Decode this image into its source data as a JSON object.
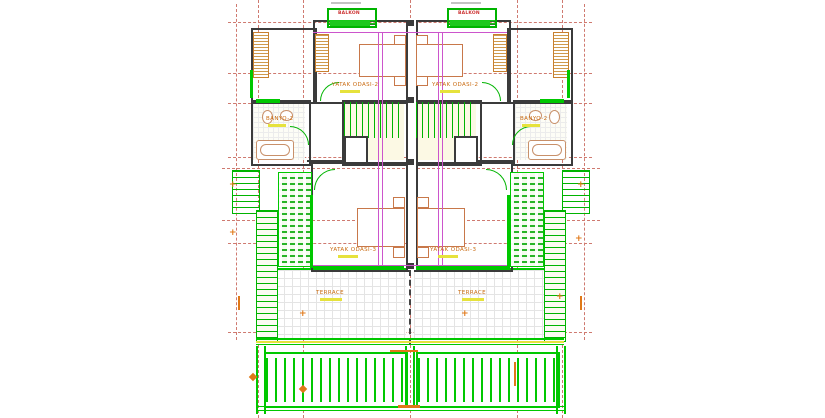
{
  "plan": {
    "type": "architectural-floor-plan",
    "labels": {
      "bedroom2": "YATAK ODASI-2",
      "bedroom3": "YATAK ODASI-3",
      "bathroom": "BANYO-2",
      "terrace": "TERRACE",
      "balcony": "BALKON",
      "level_marker": "+"
    },
    "colors": {
      "grid_axis_red": "#cf7a70",
      "wall_dark": "#3b3b3b",
      "landscape_green": "#00c800",
      "section_magenta": "#cc55cc",
      "annotation_orange": "#e07818",
      "area_highlight_yellow": "#e6e23c",
      "furniture_orange": "#c8784a"
    }
  }
}
